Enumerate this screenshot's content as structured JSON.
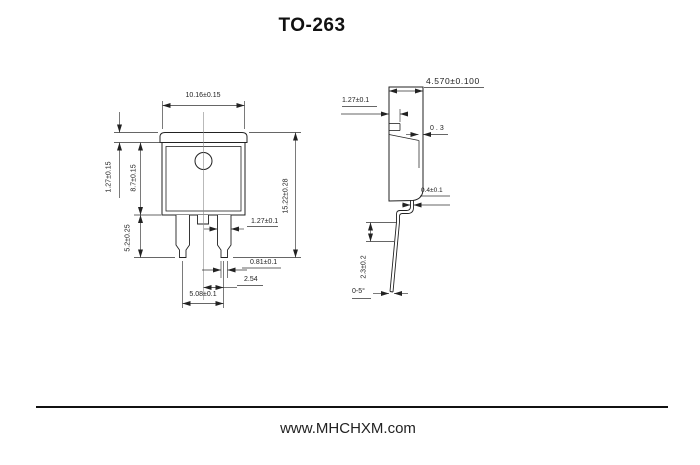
{
  "title": "TO-263",
  "front_view": {
    "body_width": "10.16±0.15",
    "tab_height": "1.27±0.15",
    "body_height": "8.7±0.15",
    "lead_length": "5.2±0.25",
    "overall_height": "15.22±0.28",
    "lead_width": "1.27±0.1",
    "lead_tip_width": "0.81±0.1",
    "lead_pitch": "2.54",
    "lead_span": "5.08±0.1"
  },
  "side_view": {
    "overall_thickness": "4.570±0.100",
    "tab_thickness": "1.27±0.1",
    "edge_step": "0.3",
    "lead_thickness": "0.4±0.1",
    "foot_height": "2.3±0.2",
    "lead_angle": "0-5°"
  },
  "footer": {
    "website": "www.MHCHXM.com"
  }
}
